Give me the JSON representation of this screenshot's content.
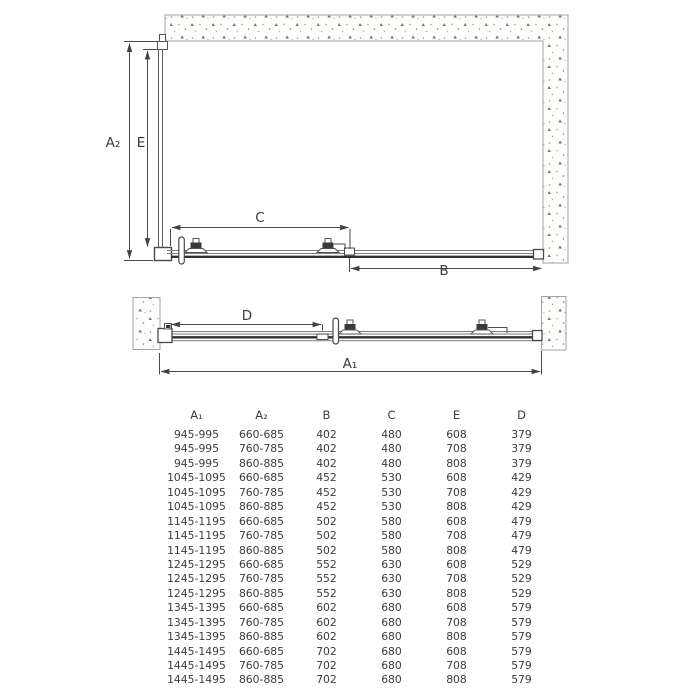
{
  "diagram": {
    "labels": {
      "a2": "A₂",
      "e": "E",
      "c": "C",
      "b": "B",
      "d": "D",
      "a1": "A₁"
    }
  },
  "table": {
    "columns": [
      "A₁",
      "A₂",
      "B",
      "C",
      "E",
      "D"
    ],
    "rows": [
      [
        "945-995",
        "660-685",
        "402",
        "480",
        "608",
        "379"
      ],
      [
        "945-995",
        "760-785",
        "402",
        "480",
        "708",
        "379"
      ],
      [
        "945-995",
        "860-885",
        "402",
        "480",
        "808",
        "379"
      ],
      [
        "1045-1095",
        "660-685",
        "452",
        "530",
        "608",
        "429"
      ],
      [
        "1045-1095",
        "760-785",
        "452",
        "530",
        "708",
        "429"
      ],
      [
        "1045-1095",
        "860-885",
        "452",
        "530",
        "808",
        "429"
      ],
      [
        "1145-1195",
        "660-685",
        "502",
        "580",
        "608",
        "479"
      ],
      [
        "1145-1195",
        "760-785",
        "502",
        "580",
        "708",
        "479"
      ],
      [
        "1145-1195",
        "860-885",
        "502",
        "580",
        "808",
        "479"
      ],
      [
        "1245-1295",
        "660-685",
        "552",
        "630",
        "608",
        "529"
      ],
      [
        "1245-1295",
        "760-785",
        "552",
        "630",
        "708",
        "529"
      ],
      [
        "1245-1295",
        "860-885",
        "552",
        "630",
        "808",
        "529"
      ],
      [
        "1345-1395",
        "660-685",
        "602",
        "680",
        "608",
        "579"
      ],
      [
        "1345-1395",
        "760-785",
        "602",
        "680",
        "708",
        "579"
      ],
      [
        "1345-1395",
        "860-885",
        "602",
        "680",
        "808",
        "579"
      ],
      [
        "1445-1495",
        "660-685",
        "702",
        "680",
        "608",
        "579"
      ],
      [
        "1445-1495",
        "760-785",
        "702",
        "680",
        "708",
        "579"
      ],
      [
        "1445-1495",
        "860-885",
        "702",
        "680",
        "808",
        "579"
      ]
    ]
  },
  "colors": {
    "line": "#4a4a4a",
    "track": "#7d7d7d",
    "glass": "#2f2f2f",
    "wall_border": "#a3a3a3",
    "text": "#3c3c3c"
  }
}
